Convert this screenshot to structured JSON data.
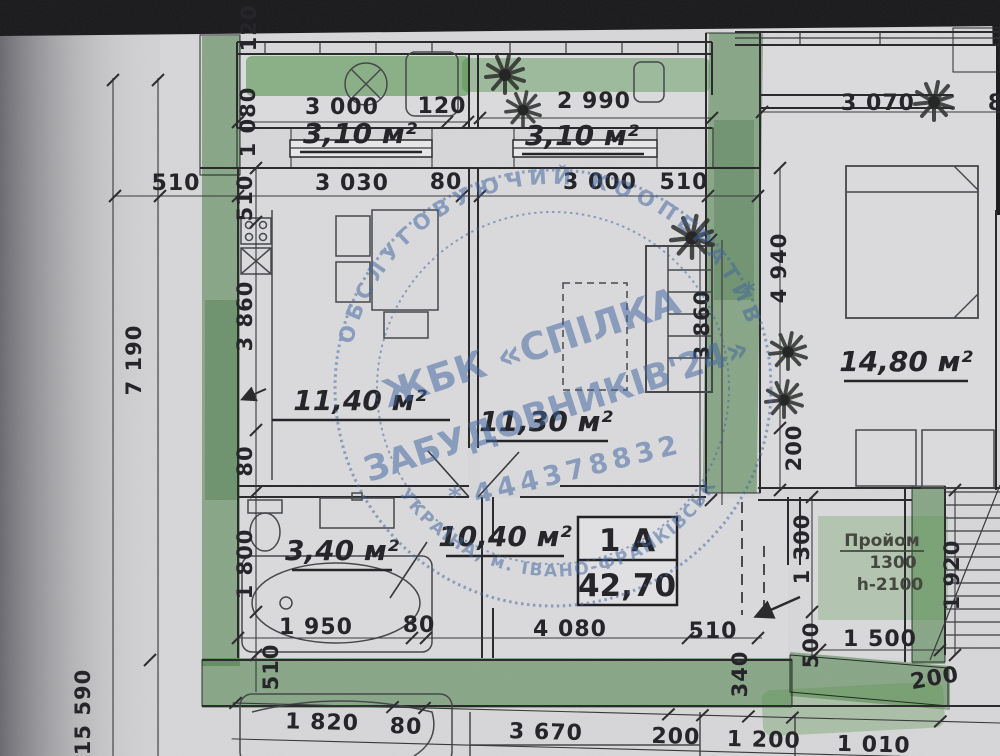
{
  "colors": {
    "paper": "#d2d2d4",
    "ink": "#26262a",
    "highlight_green": "#58a64e",
    "stamp_blue": "#41659f",
    "scan_border": "#17171a"
  },
  "apartment_label": {
    "unit": "1 А",
    "total_area": "42,70"
  },
  "room_areas": {
    "balcony_1": "3,10 м²",
    "balcony_2": "3,10 м²",
    "kitchen": "11,40 м²",
    "living_room": "11,30 м²",
    "neighbor_room": "14,80 м²",
    "bathroom": "3,40 м²",
    "hallway": "10,40 м²"
  },
  "opening_note": {
    "title": "Пройом",
    "width": "1300",
    "height": "h-2100"
  },
  "stamp": {
    "ring_top": "ОБСЛУГОВУЮЧИЙ КООПЕРАТИВ",
    "ring_bottom": "УКРАЇНА, м. ІВАНО-ФРАНКІВСЬК",
    "name_line_1": "ЖБК «СПІЛКА",
    "name_line_2": "ЗАБУДОВНИКІВ'24»",
    "code": "444378832",
    "asterisk": "*"
  },
  "dims": {
    "t_120_edge": "120",
    "t_1080": "1 080",
    "t_3000": "3 000",
    "t_120": "120",
    "t_2990": "2 990",
    "t_3070": "3 070",
    "t_8": "8",
    "u_510_l": "510",
    "u_3030": "3 030",
    "u_80": "80",
    "u_3000": "3 000",
    "u_510_r": "510",
    "l_510": "510",
    "l_3860": "3 860",
    "l_80": "80",
    "l_1800": "1 800",
    "l_510_b": "510",
    "l_7190": "7 190",
    "l_15590": "15 590",
    "r_3860": "3 860",
    "r_4940": "4 940",
    "r_200": "200",
    "e_1300": "1 300",
    "e_500": "500",
    "e_1500": "1 500",
    "e_1920": "1 920",
    "e_200": "200",
    "e_340": "340",
    "b_1950": "1 950",
    "b_80": "80",
    "b_4080": "4 080",
    "b_510": "510",
    "z_1820": "1 820",
    "z_80": "80",
    "z_3670": "3 670",
    "z_200": "200",
    "z_1200": "1 200",
    "z_1010": "1 010"
  }
}
